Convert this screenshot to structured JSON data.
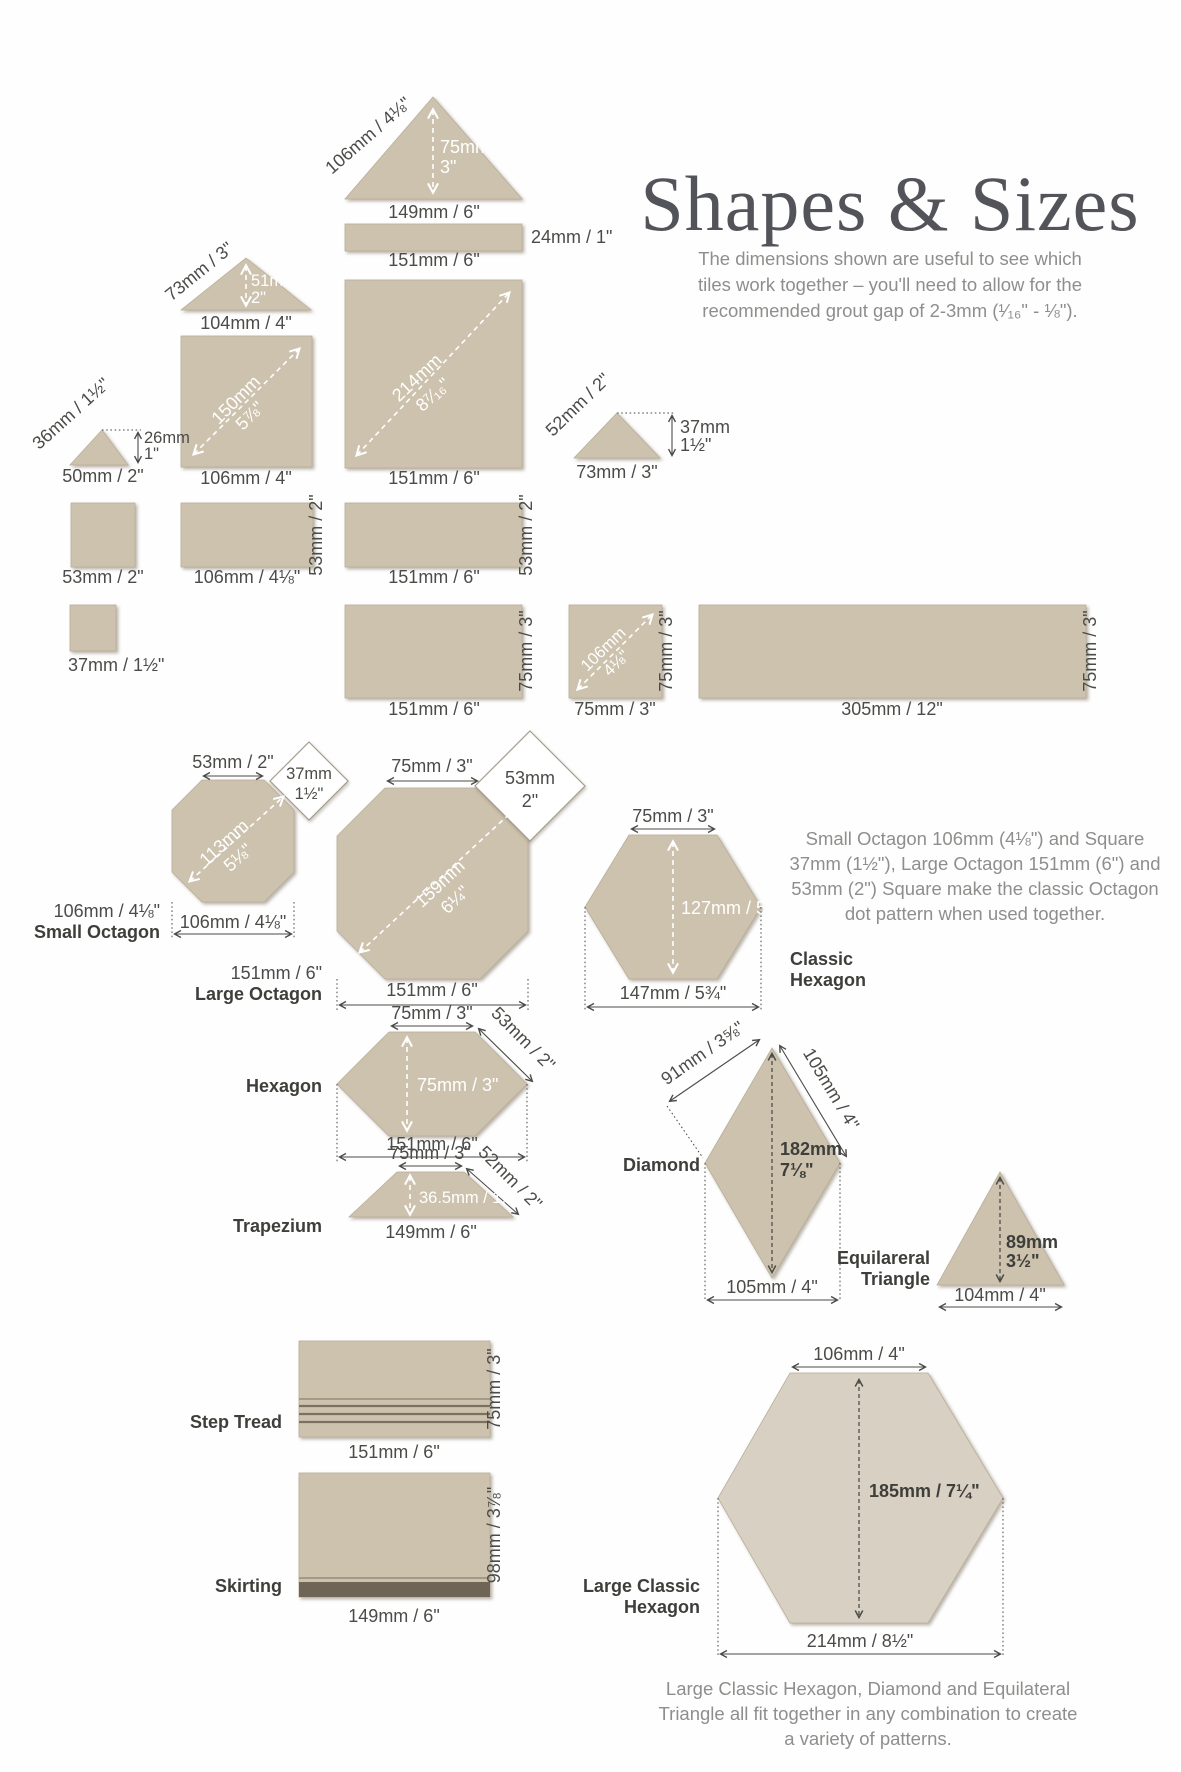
{
  "title": "Shapes & Sizes",
  "intro": {
    "l1": "The dimensions shown are useful to see which",
    "l2": "tiles work together – you'll need to allow for the",
    "l3": "recommended grout gap of 2-3mm (¹⁄₁₆\" - ⅛\")."
  },
  "octagon_note": {
    "l1": "Small Octagon 106mm (4⅛\") and Square",
    "l2": "37mm (1½\"), Large Octagon 151mm (6\") and",
    "l3": "53mm (2\") Square make the classic Octagon",
    "l4": "dot pattern when used together."
  },
  "footer_note": {
    "l1": "Large Classic Hexagon, Diamond and Equilateral",
    "l2": "Triangle all fit together in any combination to create",
    "l3": "a variety of patterns."
  },
  "colors": {
    "tile": "#cdc2ae",
    "tile_light": "#d8d0c2",
    "tile_edge": "#b9ae99",
    "ink": "#4b4b48",
    "muted": "#8e8e8c",
    "title_ink": "#53545a",
    "skirting_base": "#6e6557"
  },
  "tiles": {
    "t149": {
      "hyp": "106mm / 4⅛\"",
      "h_mm": "75mm",
      "h_in": "3\"",
      "base": "149mm / 6\""
    },
    "strip24": {
      "side": "24mm / 1\"",
      "base": "151mm / 6\""
    },
    "t104": {
      "hyp": "73mm / 3\"",
      "h_mm": "51mm",
      "h_in": "2\"",
      "base": "104mm / 4\""
    },
    "sq106": {
      "diag_mm": "150mm",
      "diag_in": "5⅞\"",
      "base": "106mm / 4\""
    },
    "t50": {
      "hyp": "36mm / 1½\"",
      "h_mm": "26mm",
      "h_in": "1\"",
      "base": "50mm / 2\""
    },
    "sq151": {
      "diag_mm": "214mm",
      "diag_in": "8⁷⁄₁₆\"",
      "base": "151mm / 6\""
    },
    "t73": {
      "hyp": "52mm / 2\"",
      "h_mm": "37mm",
      "h_in": "1½\"",
      "base": "73mm / 3\""
    },
    "sq53": {
      "base": "53mm / 2\""
    },
    "r106": {
      "side": "53mm / 2\"",
      "base": "106mm / 4⅛\""
    },
    "r151": {
      "side": "53mm / 2\"",
      "base": "151mm / 6\""
    },
    "sq37": {
      "base": "37mm / 1½\""
    },
    "r151x75": {
      "side": "75mm / 3\"",
      "base": "151mm / 6\""
    },
    "sq75": {
      "diag_mm": "106mm",
      "diag_in": "4⅛\"",
      "side": "75mm / 3\"",
      "base": "75mm / 3\""
    },
    "r305": {
      "side": "75mm / 3\"",
      "base": "305mm / 12\""
    },
    "small_oct": {
      "top": "53mm / 2\"",
      "sq_mm": "37mm",
      "sq_in": "1½\"",
      "diag_mm": "113mm",
      "diag_in": "5⅛\"",
      "label1": "106mm / 4⅛\"",
      "label2": "Small Octagon",
      "base": "106mm / 4⅛\""
    },
    "large_oct": {
      "top": "75mm / 3\"",
      "sq_mm": "53mm",
      "sq_in": "2\"",
      "diag_mm": "159mm",
      "diag_in": "6¼\"",
      "label1": "151mm / 6\"",
      "label2": "Large Octagon",
      "base": "151mm / 6\""
    },
    "classic_hex": {
      "top": "75mm / 3\"",
      "height": "127mm / 5\"",
      "base": "147mm / 5¾\"",
      "label1": "Classic",
      "label2": "Hexagon"
    },
    "hexagon": {
      "top": "75mm / 3\"",
      "slope": "53mm / 2\"",
      "height": "75mm / 3\"",
      "base": "151mm / 6\"",
      "label": "Hexagon"
    },
    "trapezium": {
      "top": "75mm / 3\"",
      "slope": "52mm / 2\"",
      "height": "36.5mm / 1.5\"",
      "base": "149mm / 6\"",
      "label": "Trapezium"
    },
    "diamond": {
      "left": "91mm / 3⅝\"",
      "right": "105mm / 4\"",
      "h_mm": "182mm",
      "h_in": "7⅛\"",
      "base": "105mm / 4\"",
      "label": "Diamond"
    },
    "equilateral": {
      "h_mm": "89mm",
      "h_in": "3½\"",
      "base": "104mm / 4\"",
      "label1": "Equilareral",
      "label2": "Triangle"
    },
    "step_tread": {
      "side": "75mm / 3\"",
      "base": "151mm / 6\"",
      "label": "Step Tread"
    },
    "skirting": {
      "side": "98mm / 3⅞\"",
      "base": "149mm / 6\"",
      "label": "Skirting"
    },
    "large_hex": {
      "top": "106mm / 4\"",
      "height": "185mm / 7¼\"",
      "base": "214mm / 8½\"",
      "label1": "Large Classic",
      "label2": "Hexagon"
    }
  }
}
